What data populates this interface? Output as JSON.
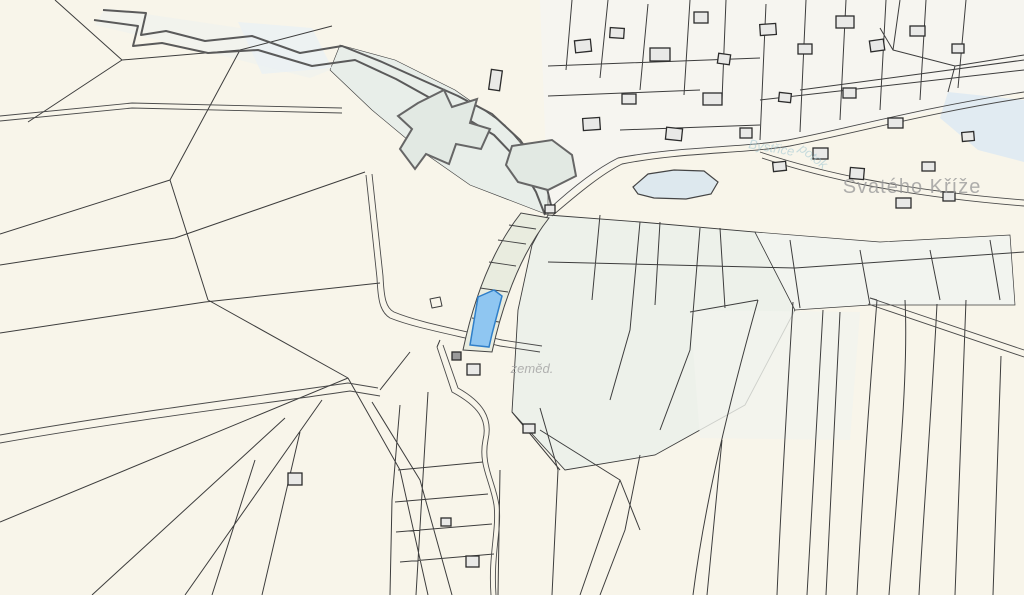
{
  "map": {
    "labels": {
      "settlement": "Svatého Kříže",
      "landuse_abbrev": "zeměd.",
      "stream_name": "Bystřice",
      "stream_word": "potok"
    },
    "colors": {
      "background": "#f8f5ea",
      "village_tint": "#f6f5f0",
      "green_tint": "#edf1ea",
      "corridor_tint": "#e8eee9",
      "strip_band": "#e9ecdf",
      "water": "#dde8ee",
      "water_wash": "#e1ebf2",
      "parcel_line": "#3d3d3d",
      "road_line": "#4a4a4a",
      "stream_line": "#5a5a5a",
      "building_fill": "#e9e9e7",
      "building_stroke": "#2c2c2c",
      "highlight_fill": "#8fc6f1",
      "highlight_stroke": "#2f7fc9"
    }
  }
}
